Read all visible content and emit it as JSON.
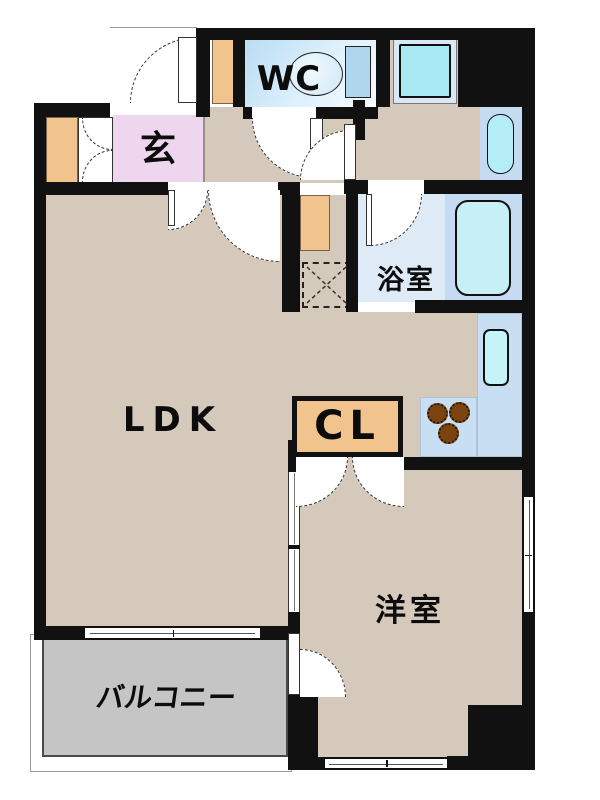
{
  "plan": {
    "type": "apartment-floor-plan",
    "rooms": {
      "genkan": {
        "label": "玄"
      },
      "wc": {
        "label": "WC"
      },
      "bathroom": {
        "label": "浴室"
      },
      "ldk": {
        "label": "LDK"
      },
      "closet": {
        "label": "CL"
      },
      "western_room": {
        "label": "洋室"
      },
      "balcony": {
        "label": "バルコニー"
      }
    },
    "fixtures": {
      "toilet": "toilet",
      "washing_machine_pan": "washing-machine-pan",
      "washbasin": "washbasin",
      "bathtub": "bathtub",
      "kitchen_sink": "kitchen-sink",
      "stove": "3-burner-gas-stove",
      "pipe_space": "pipe-space"
    },
    "colors": {
      "wall": "#111111",
      "floor": "#d5c9bb",
      "genkan_pink": "#eed6ee",
      "wood_accent": "#f0c48c",
      "wet_area_blue": "#c4dbf1",
      "fixture_cyan": "#a9e9f3",
      "bath_floor": "#dfeaf7",
      "kitchen_counter": "#c8def3",
      "balcony_gray": "#c5c5c5",
      "burner_brown": "#7a430f"
    }
  }
}
